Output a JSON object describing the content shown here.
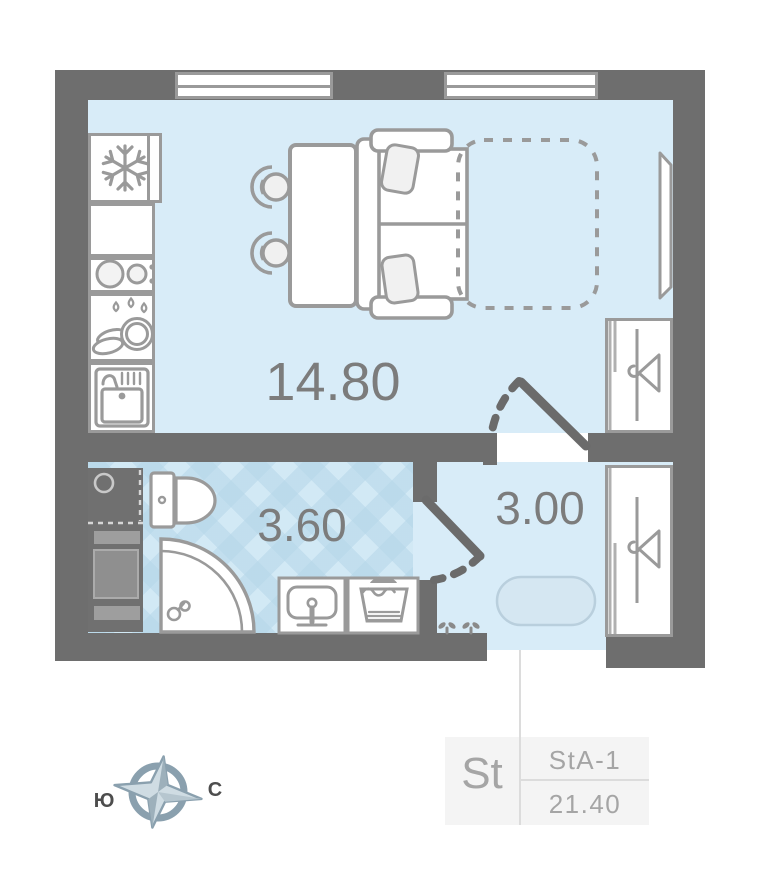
{
  "floorplan": {
    "rooms": [
      {
        "id": "living-kitchen",
        "area_label": "14.80"
      },
      {
        "id": "bathroom",
        "area_label": "3.60"
      },
      {
        "id": "hallway",
        "area_label": "3.00"
      }
    ],
    "apartment_card": {
      "type_label": "St",
      "layout_code": "StA-1",
      "total_area": "21.40"
    },
    "compass": {
      "south_label": "Ю",
      "north_label": "С"
    },
    "icons": {
      "fridge": "snowflake-icon",
      "stove": "burners-icon",
      "dish_dryer": "dishes-icon",
      "kitchen_sink": "sink-icon",
      "wardrobe": "hanger-icon",
      "bathroom": [
        "toilet-icon",
        "shower-icon",
        "washbasin-icon",
        "laundry-tub-icon"
      ]
    },
    "colors": {
      "wall": "#6e6e6e",
      "floor": "#d8ecf8",
      "bath_floor": "#d2e9f5",
      "furniture_stroke": "#9a9a9a",
      "label_text": "#7c7c7c",
      "card_bg": "#f4f4f4",
      "card_text": "#a5a5a5",
      "compass_blue": "#8aa0ae",
      "door_dark": "#6b6b6b"
    }
  }
}
